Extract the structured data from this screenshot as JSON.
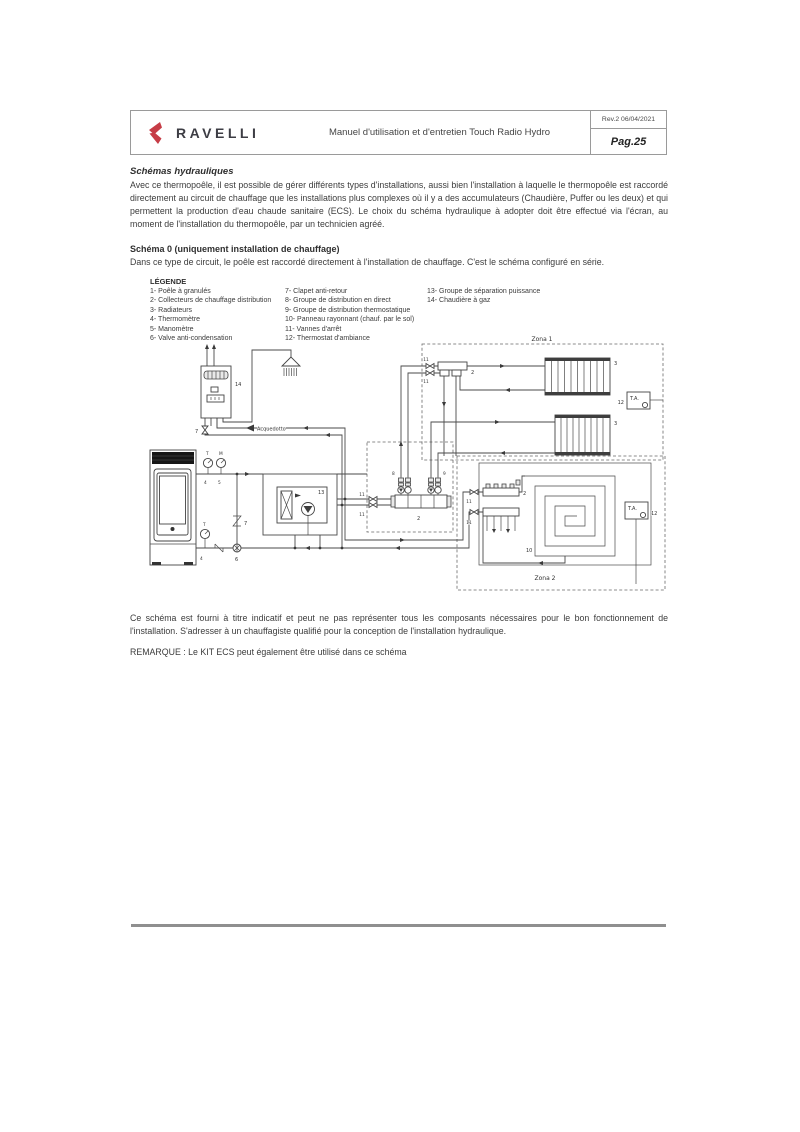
{
  "header": {
    "brand": "RAVELLI",
    "title": "Manuel d'utilisation et d'entretien Touch Radio Hydro",
    "rev": "Rev.2  06/04/2021",
    "page": "Pag.25"
  },
  "section": {
    "title": "Schémas hydrauliques",
    "body": "Avec ce thermopoêle, il est possible de gérer différents types d'installations, aussi bien l'installation à laquelle le thermopoêle est raccordé directement au circuit de chauffage que les installations plus complexes où il y a des accumulateurs (Chaudière, Puffer ou les deux) et qui permettent la production d'eau chaude sanitaire (ECS). Le choix du schéma hydraulique à adopter doit être effectué via l'écran, au moment de l'installation du thermopoêle, par un technicien agréé."
  },
  "schema0": {
    "title": "Schéma 0 (uniquement installation de chauffage)",
    "body": "Dans ce type de circuit, le poêle est raccordé directement à l'installation de chauffage. C'est le schéma configuré en série."
  },
  "legend": {
    "title": "LÉGENDE",
    "col1": [
      "1- Poêle à granulés",
      "2- Collecteurs de chauffage distribution",
      "3- Radiateurs",
      "4- Thermomètre",
      "5- Manomètre",
      "6- Valve anti-condensation"
    ],
    "col2": [
      "7- Clapet anti-retour",
      "8- Groupe de distribution en direct",
      "9- Groupe de distribution thermostatique",
      "10- Panneau rayonnant (chauf. par le sol)",
      "11- Vannes d'arrêt",
      "12- Thermostat d'ambiance"
    ],
    "col3": [
      "13- Groupe de séparation puissance",
      "14- Chaudière à gaz"
    ]
  },
  "diagram": {
    "zona1": "Zona 1",
    "zona2": "Zona 2",
    "acquedotto": "Acquedotto",
    "ta": "T.A.",
    "t": "T",
    "m": "M",
    "n2": "2",
    "n3": "3",
    "n4": "4",
    "n5": "5",
    "n6": "6",
    "n7": "7",
    "n8": "8",
    "n9": "9",
    "n10": "10",
    "n11": "11",
    "n12": "12",
    "n13": "13",
    "n14": "14"
  },
  "footer": {
    "note": "Ce schéma est fourni à titre indicatif et peut ne pas représenter tous les composants nécessaires pour le bon fonctionnement de l'installation. S'adresser à un chauffagiste qualifié pour la conception de l'installation hydraulique.",
    "remark": "REMARQUE : Le KIT ECS peut également être utilisé dans ce schéma"
  },
  "colors": {
    "brand_red": "#c63c46",
    "text": "#3c3c3c",
    "rule_grey": "#8f8f8f"
  }
}
